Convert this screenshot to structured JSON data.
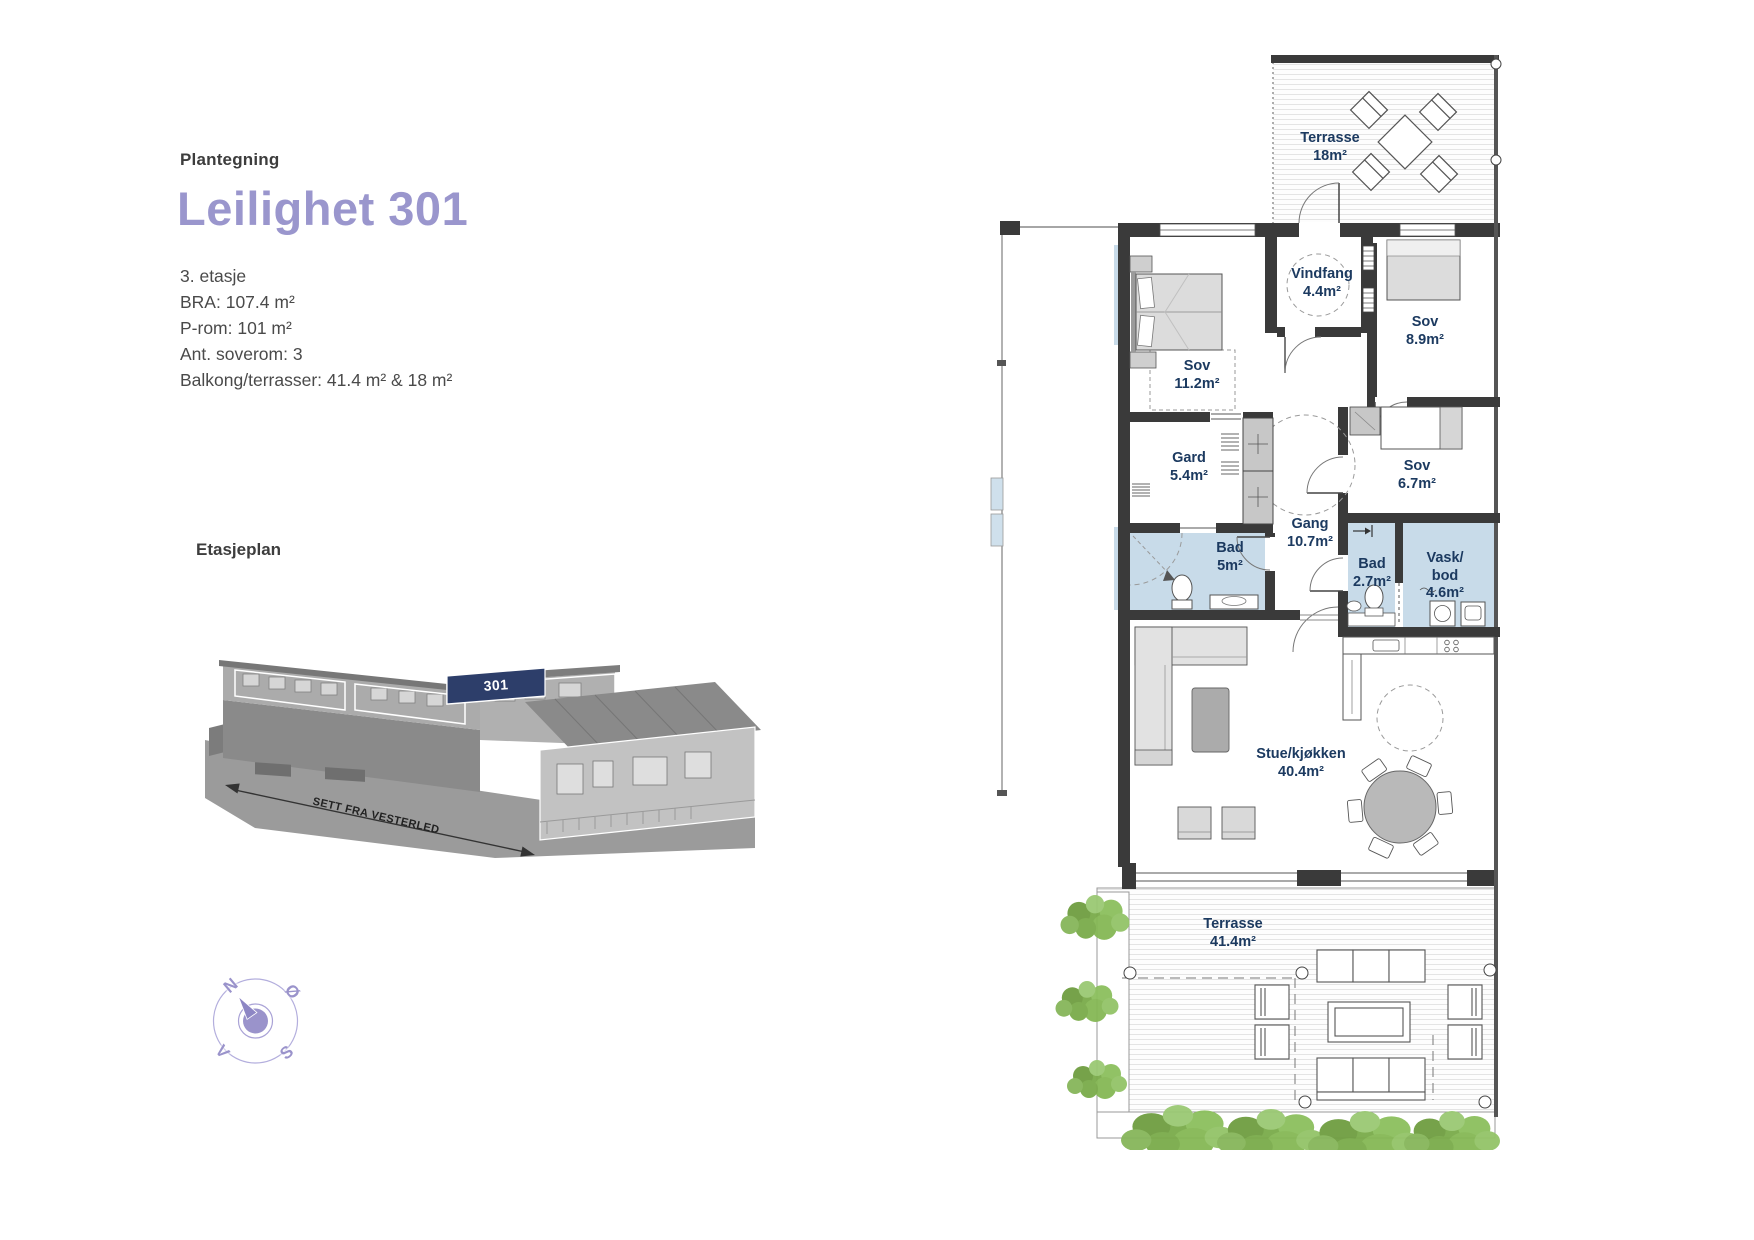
{
  "panel": {
    "kicker": "Plantegning",
    "title": "Leilighet 301",
    "details": [
      "3. etasje",
      "BRA: 107.4 m²",
      "P-rom: 101  m²",
      "Ant. soverom: 3",
      "Balkong/terrasser: 41.4 m² & 18 m²"
    ],
    "floorplan_heading": "Etasjeplan",
    "building_unit_label": "301",
    "view_caption": "SETT FRA VESTERLED",
    "compass": {
      "north": "N",
      "east": "Ø",
      "south": "S",
      "west": "V"
    }
  },
  "plan": {
    "rooms": [
      {
        "name": "Terrasse",
        "area": "18m²"
      },
      {
        "name": "Sov",
        "area": "11.2m²"
      },
      {
        "name": "Vindfang",
        "area": "4.4m²"
      },
      {
        "name": "Sov",
        "area": "8.9m²"
      },
      {
        "name": "Gard",
        "area": "5.4m²"
      },
      {
        "name": "Sov",
        "area": "6.7m²"
      },
      {
        "name": "Gang",
        "area": "10.7m²"
      },
      {
        "name": "Bad",
        "area": "5m²"
      },
      {
        "name": "Bad",
        "area": "2.7m²"
      },
      {
        "name": "Vask/\nbod",
        "area": "4.6m²"
      },
      {
        "name": "Stue/kjøkken",
        "area": "40.4m²"
      },
      {
        "name": "Terrasse",
        "area": "41.4m²"
      }
    ]
  },
  "colors": {
    "accent_title": "#9a96cd",
    "room_label": "#1c3a60",
    "wet_room_fill": "#c8dbe9",
    "wall": "#3a3a3a",
    "unit_highlight": "#2d3e6a",
    "greenery": "#7fae4e"
  }
}
